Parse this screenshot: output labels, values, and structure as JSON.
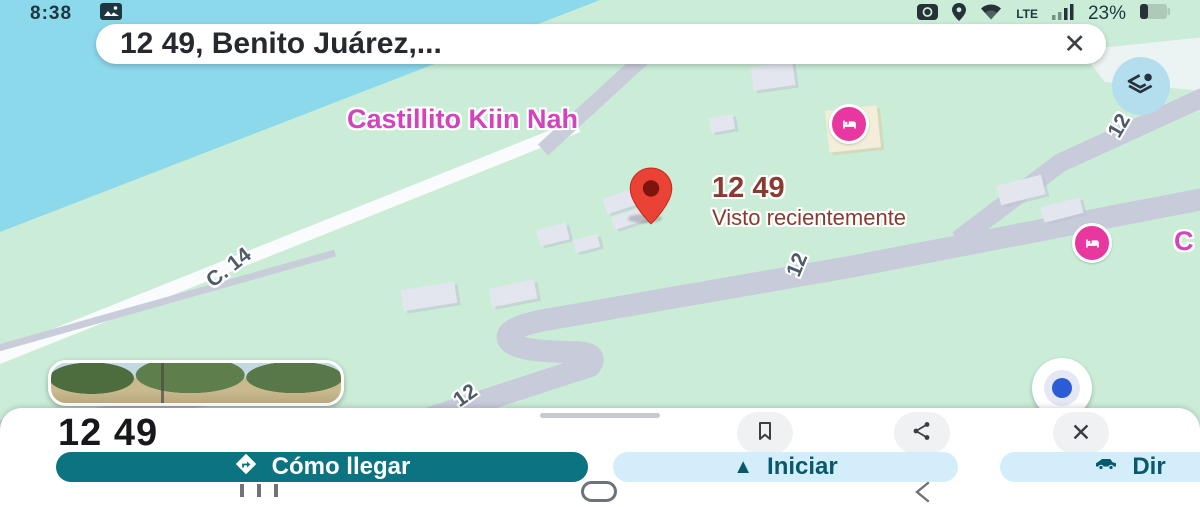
{
  "status_bar": {
    "time": "8:38",
    "battery_percent": "23%",
    "network_label": "LTE",
    "icons": [
      "photo-icon",
      "camera-icon",
      "location-icon",
      "wifi-icon",
      "signal-icon",
      "battery-icon"
    ]
  },
  "search_bar": {
    "query": "12 49, Benito Juárez,...",
    "close_icon": "close-icon"
  },
  "map": {
    "colors": {
      "land": "#CBEDD8",
      "water": "#8CD9EC",
      "road": "#C7CBDA",
      "road_minor": "#FAFBFD",
      "building": "#E4E6EF",
      "building_beige": "#F2EEDA",
      "poi_pink": "#E8389F",
      "pin_red": "#EA4335",
      "place_label": "#8A3A2E",
      "road_label": "#4E5B68",
      "poi_label": "#D343BB"
    },
    "poi_castillito": {
      "label": "Castillito Kiin Nah",
      "icon": "lodging-icon"
    },
    "pin_place": {
      "title": "12 49",
      "subtitle": "Visto recientemente"
    },
    "poi_partial": {
      "label": "C",
      "icon": "lodging-icon"
    },
    "road_labels": [
      {
        "text": "12"
      },
      {
        "text": "12"
      },
      {
        "text": "12"
      },
      {
        "text": "C. 14"
      }
    ]
  },
  "controls": {
    "layers_button": "layers-icon",
    "street_view_thumbnail": "street-view-preview",
    "my_location_button": "my-location-dot"
  },
  "sheet": {
    "title": "12 49",
    "action_icons": [
      "bookmark-icon",
      "share-icon",
      "close-icon"
    ],
    "buttons": [
      {
        "label": "Cómo llegar",
        "icon": "directions-icon"
      },
      {
        "label": "Iniciar",
        "icon": "navigate-icon"
      },
      {
        "label": "Dir",
        "icon": "vehicle-icon"
      }
    ]
  },
  "nav_bar": {
    "icons": [
      "recents-icon",
      "home-icon",
      "back-icon"
    ]
  }
}
